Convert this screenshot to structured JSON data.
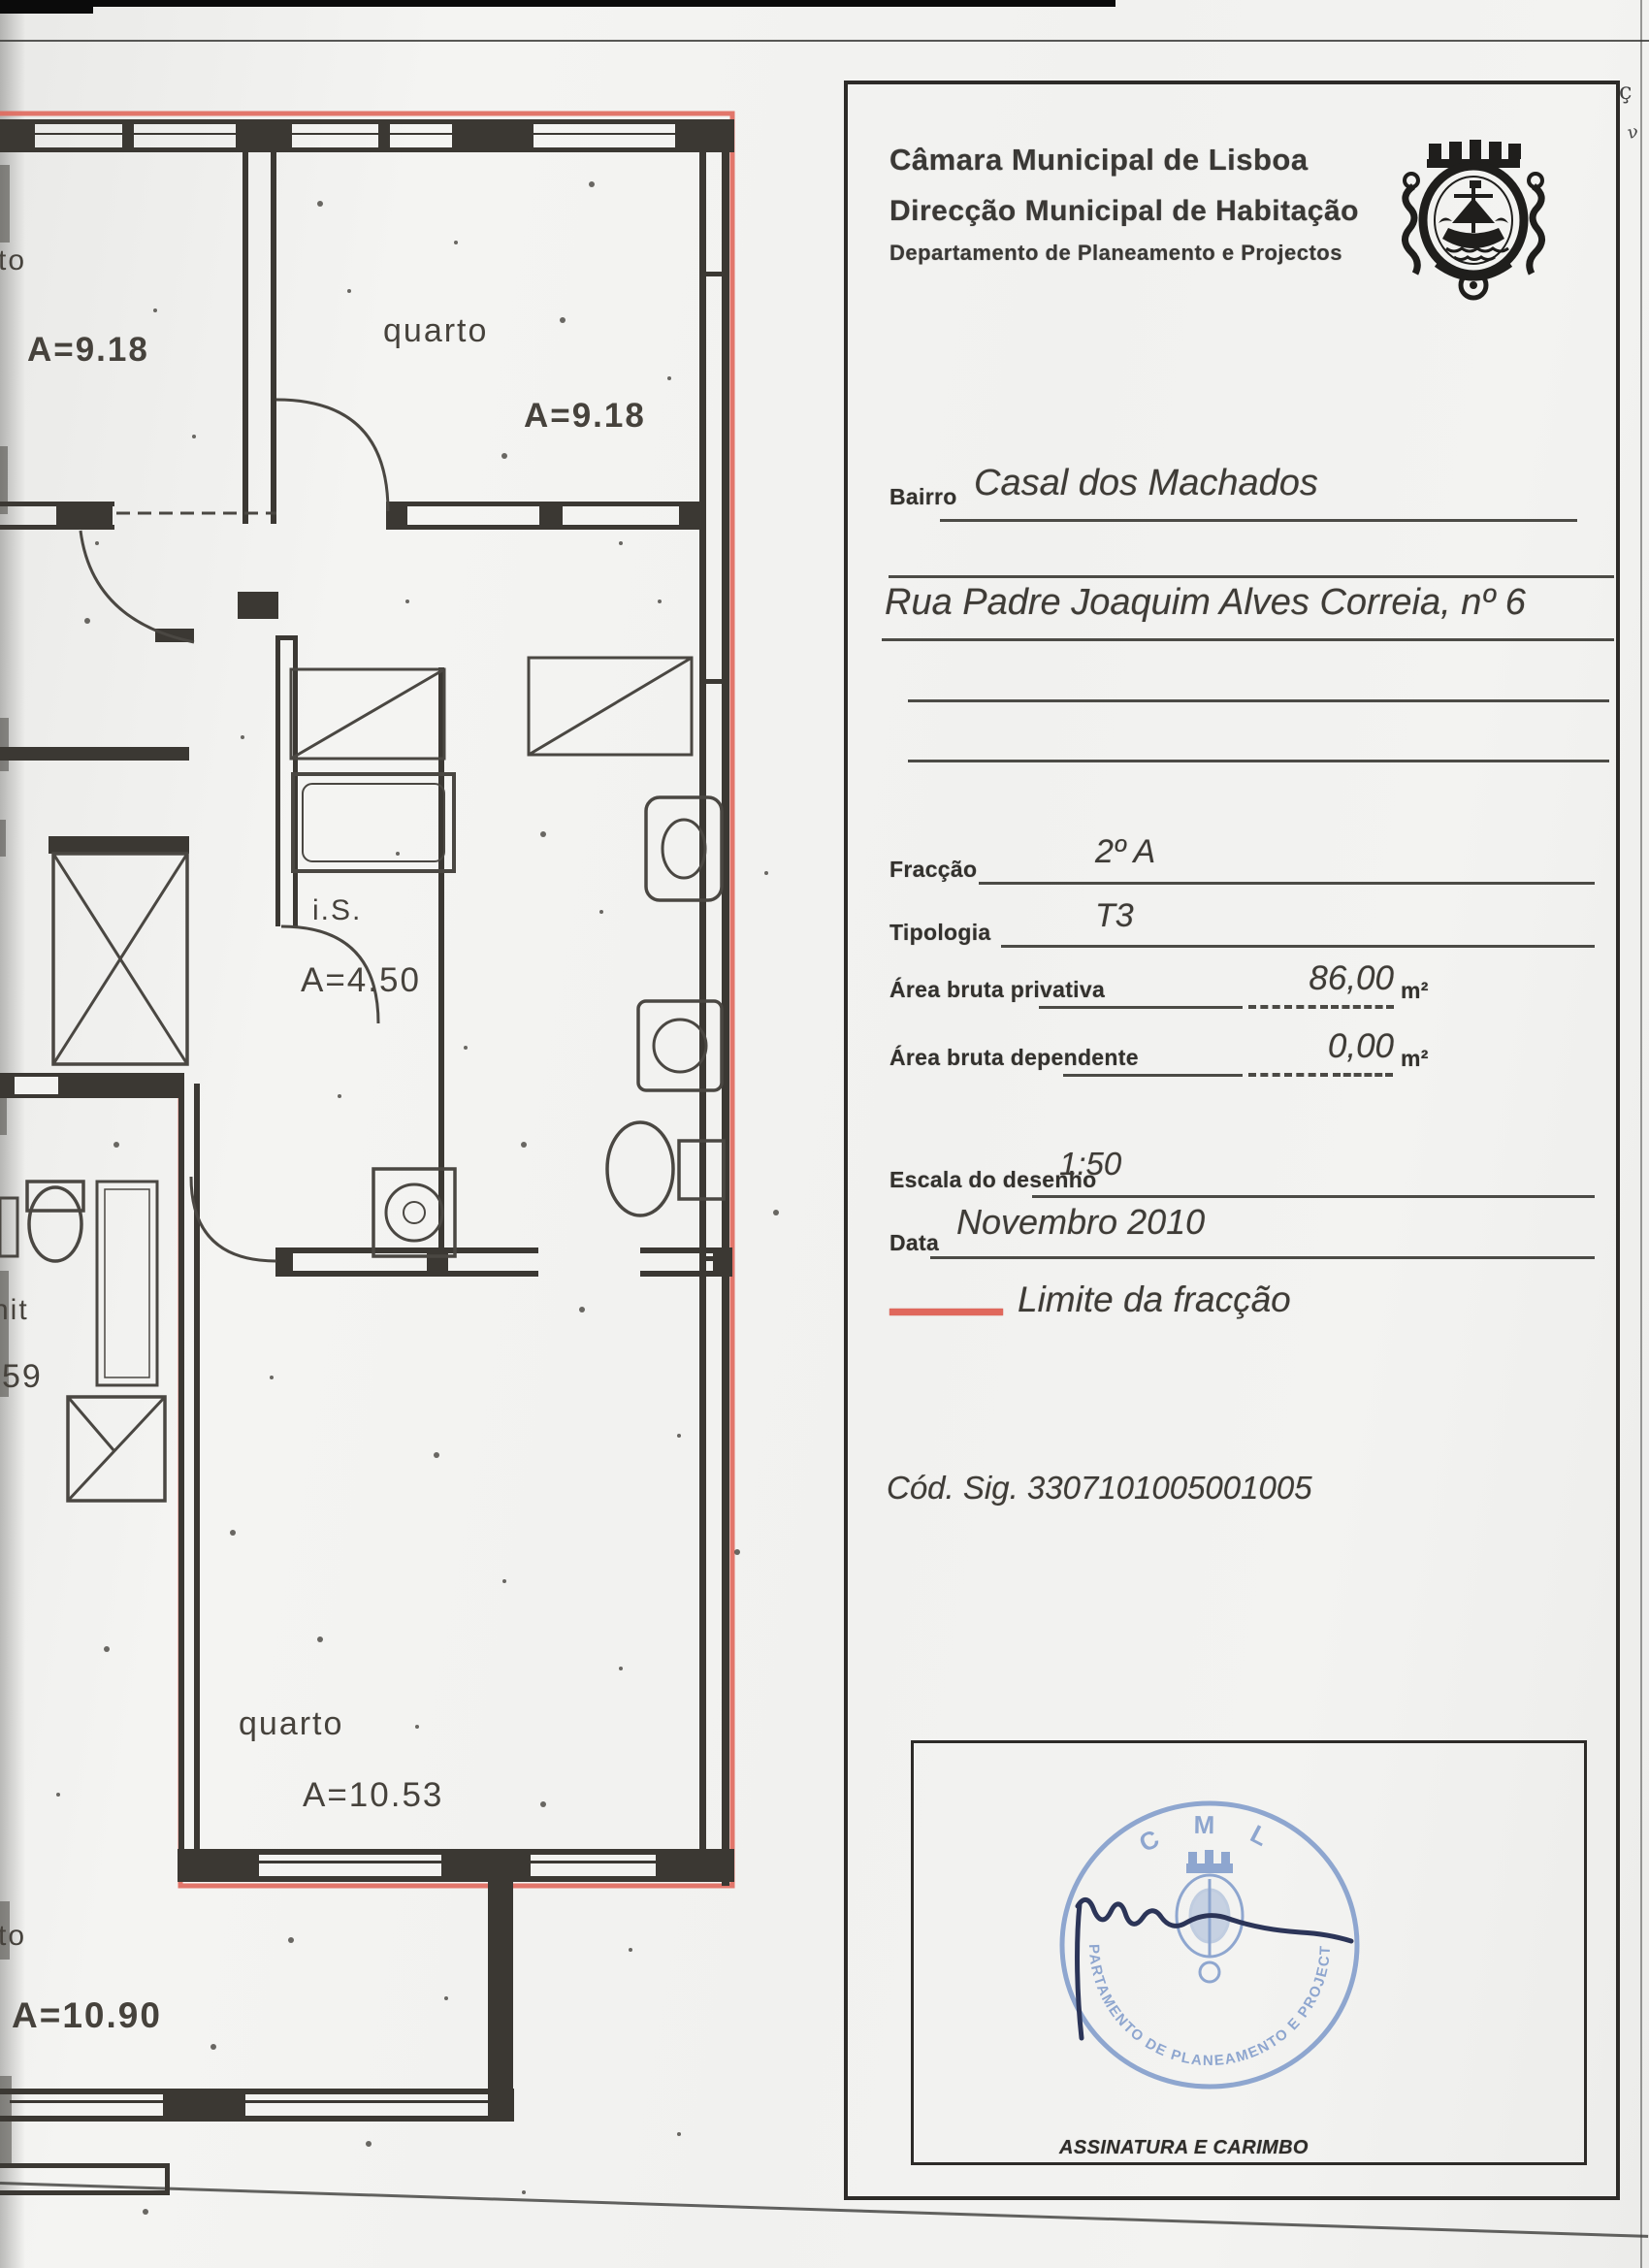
{
  "header": {
    "line1": "Câmara Municipal de Lisboa",
    "line2": "Direcção Municipal de Habitação",
    "line3": "Departamento de Planeamento e Projectos",
    "crest_icon": "lisbon-coat-of-arms"
  },
  "fields": {
    "bairro_label": "Bairro",
    "bairro_value": "Casal dos Machados",
    "address_value": "Rua Padre Joaquim Alves Correia, nº 6",
    "fraccao_label": "Fracção",
    "fraccao_value": "2º A",
    "tipologia_label": "Tipologia",
    "tipologia_value": "T3",
    "area_privativa_label": "Área bruta privativa",
    "area_privativa_value": "86,00",
    "area_privativa_unit": "m²",
    "area_dependente_label": "Área bruta dependente",
    "area_dependente_value": "0,00",
    "area_dependente_unit": "m²",
    "escala_label": "Escala do desenho",
    "escala_value": "1:50",
    "data_label": "Data",
    "data_value": "Novembro 2010",
    "legend_label": "Limite da fracção",
    "legend_color": "#e0685c",
    "cod_sig": "Cód. Sig. 3307101005001005"
  },
  "signature": {
    "caption": "ASSINATURA E CARIMBO",
    "stamp_top": "C M L",
    "stamp_ring": "DEPARTAMENTO DE PLANEAMENTO E PROJECTOS",
    "stamp_color": "#7d99ca"
  },
  "floorplan": {
    "scale": "1:50",
    "boundary_color": "#e0685c",
    "rooms": [
      {
        "name": "rto",
        "area": "A=9.18",
        "position": "top-left (cut by scan edge)"
      },
      {
        "name": "quarto",
        "area": "A=9.18",
        "position": "top-right"
      },
      {
        "name": "i.S.",
        "area": "A=4.50",
        "position": "bathroom middle"
      },
      {
        "name": "quarto",
        "area": "A=10.53",
        "position": "bottom"
      },
      {
        "name": "nit",
        "area": "59",
        "position": "left neighbour (cut by scan edge)"
      },
      {
        "name": "rto",
        "area": "A=10.90",
        "position": "bottom-left neighbour (cut by scan edge)"
      }
    ]
  }
}
